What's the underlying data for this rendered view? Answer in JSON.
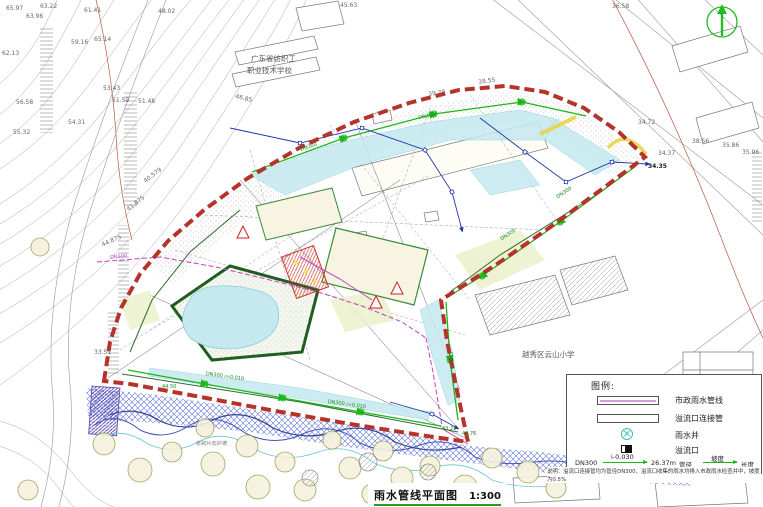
{
  "title_block": {
    "text": "雨水管线平面图",
    "scale": "1:300"
  },
  "legend": {
    "title": "图例:",
    "items": [
      {
        "name": "municipal-rain-pipe",
        "label": "市政雨水管线"
      },
      {
        "name": "overflow-connector-pipe",
        "label": "溢流口连接管"
      },
      {
        "name": "rain-well",
        "label": "雨水井"
      },
      {
        "name": "overflow-outlet",
        "label": "溢流口"
      }
    ],
    "sample": {
      "diameter": "DN300",
      "slope": "i-0.030",
      "length": "26.37m",
      "diameter_label": "管径",
      "slope_label": "坡度",
      "length_label": "长度"
    },
    "note": "说明：溢流口连接管均为管径DN300，溢流口收集的雨水均排入市政雨水检查井中，坡度为0.5%"
  },
  "colors": {
    "boundary_red": "#b5332a",
    "pipe_green": "#18b818",
    "pipe_magenta": "#c43fc4",
    "drain_blue": "#2233aa",
    "water_cyan": "#c5e9ef",
    "north_green": "#22bb22"
  },
  "map_labels": [
    {
      "text": "65.97",
      "x": 6,
      "y": 6
    },
    {
      "text": "63.22",
      "x": 40,
      "y": 4
    },
    {
      "text": "63.96",
      "x": 26,
      "y": 14
    },
    {
      "text": "61.41",
      "x": 84,
      "y": 8
    },
    {
      "text": "65.14",
      "x": 94,
      "y": 37
    },
    {
      "text": "59.16",
      "x": 71,
      "y": 40
    },
    {
      "text": "62.13",
      "x": 2,
      "y": 51
    },
    {
      "text": "56.58",
      "x": 16,
      "y": 100
    },
    {
      "text": "53.43",
      "x": 103,
      "y": 86
    },
    {
      "text": "51.59",
      "x": 112,
      "y": 98
    },
    {
      "text": "51.48",
      "x": 138,
      "y": 99
    },
    {
      "text": "54.31",
      "x": 68,
      "y": 120
    },
    {
      "text": "55.32",
      "x": 13,
      "y": 130
    },
    {
      "text": "48.02",
      "x": 158,
      "y": 9
    },
    {
      "text": "45.63",
      "x": 340,
      "y": 3
    },
    {
      "text": "36.58",
      "x": 612,
      "y": 4
    },
    {
      "text": "40.579",
      "x": 143,
      "y": 180,
      "rot": -38
    },
    {
      "text": "41.875",
      "x": 126,
      "y": 208,
      "rot": -38
    },
    {
      "text": "44.875",
      "x": 101,
      "y": 243,
      "rot": -24
    },
    {
      "text": "46.85",
      "x": 236,
      "y": 94,
      "rot": 14
    },
    {
      "text": "39.78",
      "x": 428,
      "y": 92,
      "rot": -8
    },
    {
      "text": "38.55",
      "x": 478,
      "y": 80,
      "rot": -8
    },
    {
      "text": "34.72",
      "x": 638,
      "y": 120
    },
    {
      "text": "38.56",
      "x": 692,
      "y": 139
    },
    {
      "text": "35.86",
      "x": 722,
      "y": 143
    },
    {
      "text": "35.96",
      "x": 742,
      "y": 150
    },
    {
      "text": "34.37",
      "x": 658,
      "y": 151
    },
    {
      "text": "34.35",
      "x": 648,
      "y": 164,
      "color": "#222",
      "bold": true
    },
    {
      "text": "33.51",
      "x": 94,
      "y": 350
    },
    {
      "text": "44.50",
      "x": 162,
      "y": 385,
      "color": "#1a8a1a",
      "size": 5
    },
    {
      "text": "43.21",
      "x": 442,
      "y": 427,
      "color": "#1a8a1a",
      "size": 5
    },
    {
      "text": "42.76",
      "x": 462,
      "y": 432,
      "color": "#1a8a1a",
      "size": 5
    },
    {
      "text": "DN500",
      "x": 110,
      "y": 256,
      "color": "#c43fc4",
      "size": 5,
      "rot": -6
    },
    {
      "text": "DN300 i=0.010",
      "x": 206,
      "y": 372,
      "color": "#1a8a1a",
      "size": 5,
      "rot": 8
    },
    {
      "text": "DN300 i=0.010",
      "x": 328,
      "y": 400,
      "color": "#1a8a1a",
      "size": 5,
      "rot": 8
    },
    {
      "text": "DN300",
      "x": 556,
      "y": 196,
      "color": "#1a8a1a",
      "size": 5,
      "rot": -33
    },
    {
      "text": "DN300",
      "x": 500,
      "y": 238,
      "color": "#1a8a1a",
      "size": 5,
      "rot": -33
    },
    {
      "text": "DN300",
      "x": 300,
      "y": 148,
      "color": "#1a8a1a",
      "size": 5,
      "rot": -18
    },
    {
      "text": "DN300",
      "x": 418,
      "y": 116,
      "color": "#1a8a1a",
      "size": 5,
      "rot": -10
    },
    {
      "text": "DN400",
      "x": 452,
      "y": 352,
      "color": "#1a8a1a",
      "size": 5,
      "rot": 84
    },
    {
      "text": "浆砌片石护坡",
      "x": 196,
      "y": 442,
      "size": 5.2,
      "color": "#777"
    },
    {
      "text": "广东省纺织工",
      "x": 251,
      "y": 55,
      "size": 7.5,
      "color": "#555"
    },
    {
      "text": "职业技术学校",
      "x": 247,
      "y": 67,
      "size": 7.5,
      "color": "#555"
    },
    {
      "text": "越秀区云山小学",
      "x": 522,
      "y": 351,
      "size": 7.5,
      "color": "#555"
    }
  ]
}
